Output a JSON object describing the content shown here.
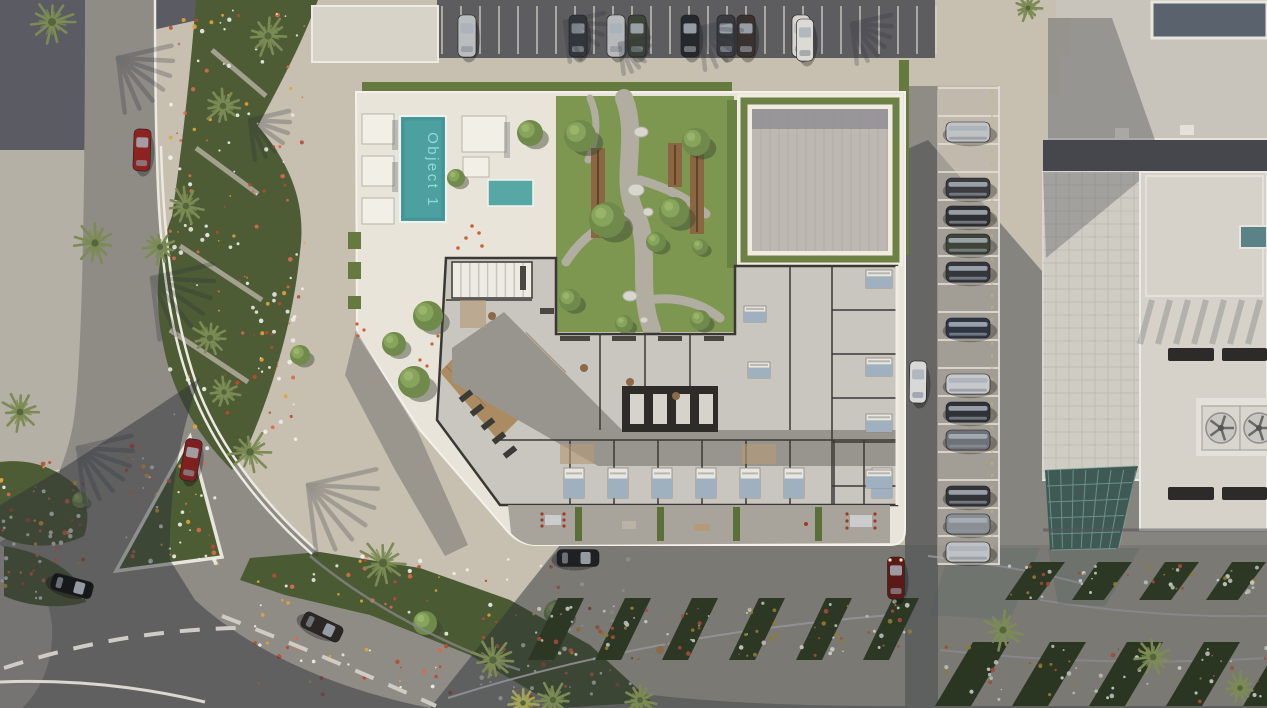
{
  "objects": [
    {
      "id": 1,
      "label": "Object 1",
      "marker": "pool-label",
      "selectable": true
    }
  ],
  "palette": {
    "pavement": "#c7c0b1",
    "pavement-cool": "#b5b0a6",
    "asphalt": "#8f8c86",
    "asphalt-dark": "#5d5c5f",
    "shadow": "#2d3138",
    "building-white": "#e9e4d9",
    "deck-white": "#f0ece2",
    "pool-water": "#4da0a0",
    "pool-label": "#97dbd8",
    "lawn": "#7d9751",
    "bed-green": "#4d5c34",
    "bed-green-dark": "#2c3724",
    "hedge": "#66793f",
    "palm": "#7c8b54",
    "plan-floor": "#c9c6c0",
    "plan-wall": "#3a3835",
    "corridor": "#98958f",
    "wood": "#ab8b61",
    "roof-paving": "#bdb9b2",
    "line-white": "#ece9e2",
    "glass": "#3f5a55",
    "car-red": "#8d2321"
  }
}
